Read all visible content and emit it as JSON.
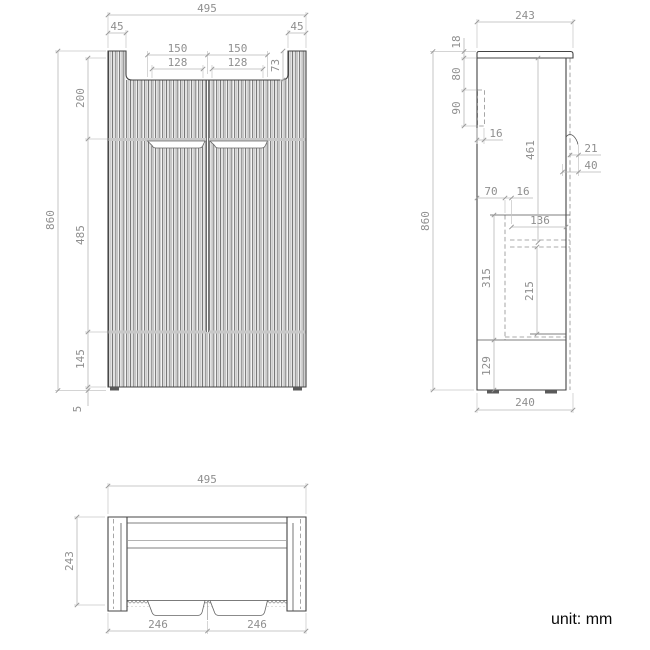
{
  "note": {
    "unit": "unit: mm"
  },
  "front": {
    "overall_width": "495",
    "side_panel_left": "45",
    "side_panel_right": "45",
    "groove_outer_left": "150",
    "groove_outer_right": "150",
    "groove_inner_left": "128",
    "groove_inner_right": "128",
    "top_recess_depth": "73",
    "overall_height": "860",
    "upper_section": "200",
    "middle_section": "485",
    "lower_section": "145",
    "floor_gap": "5"
  },
  "side": {
    "overall_depth": "243",
    "top_panel_thickness": "18",
    "upper_offset": "80",
    "bracket_height": "90",
    "bracket_depth": "16",
    "door_height": "461",
    "handle_lip": "21",
    "handle_recess": "40",
    "overall_height": "860",
    "shelf_offset": "70",
    "panel_thickness": "16",
    "inner_depth": "136",
    "drawer_space": "315",
    "drawer_height": "215",
    "base_height": "129",
    "base_depth": "240"
  },
  "bottom": {
    "overall_width": "495",
    "overall_depth": "243",
    "door_left": "246",
    "door_right": "246"
  }
}
